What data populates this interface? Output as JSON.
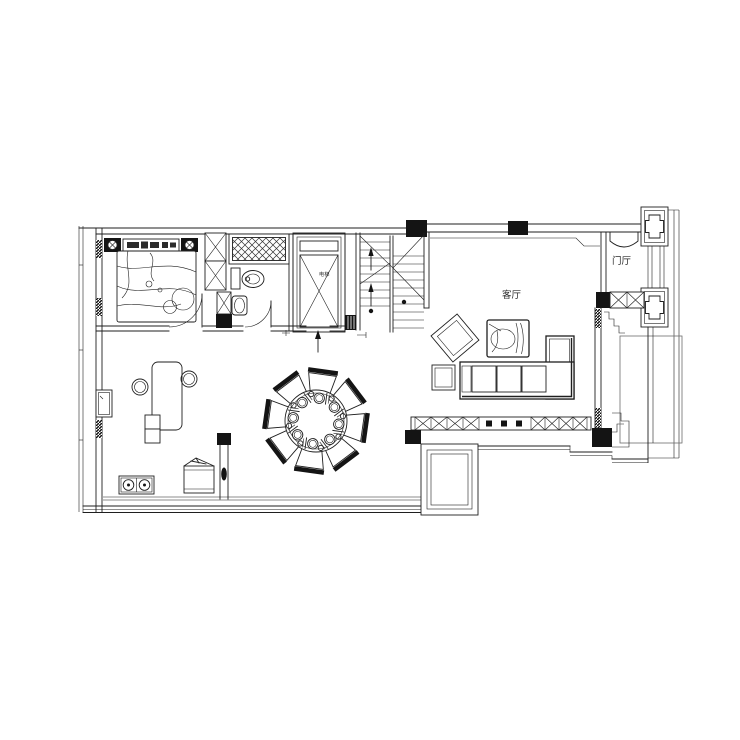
{
  "plan": {
    "labels": {
      "living_room": "客厅",
      "entrance_hall": "门厅",
      "elevator": "电梯"
    },
    "colors": {
      "ink": "#1f1f1f",
      "paper": "#ffffff",
      "column_fill": "#141414"
    }
  }
}
